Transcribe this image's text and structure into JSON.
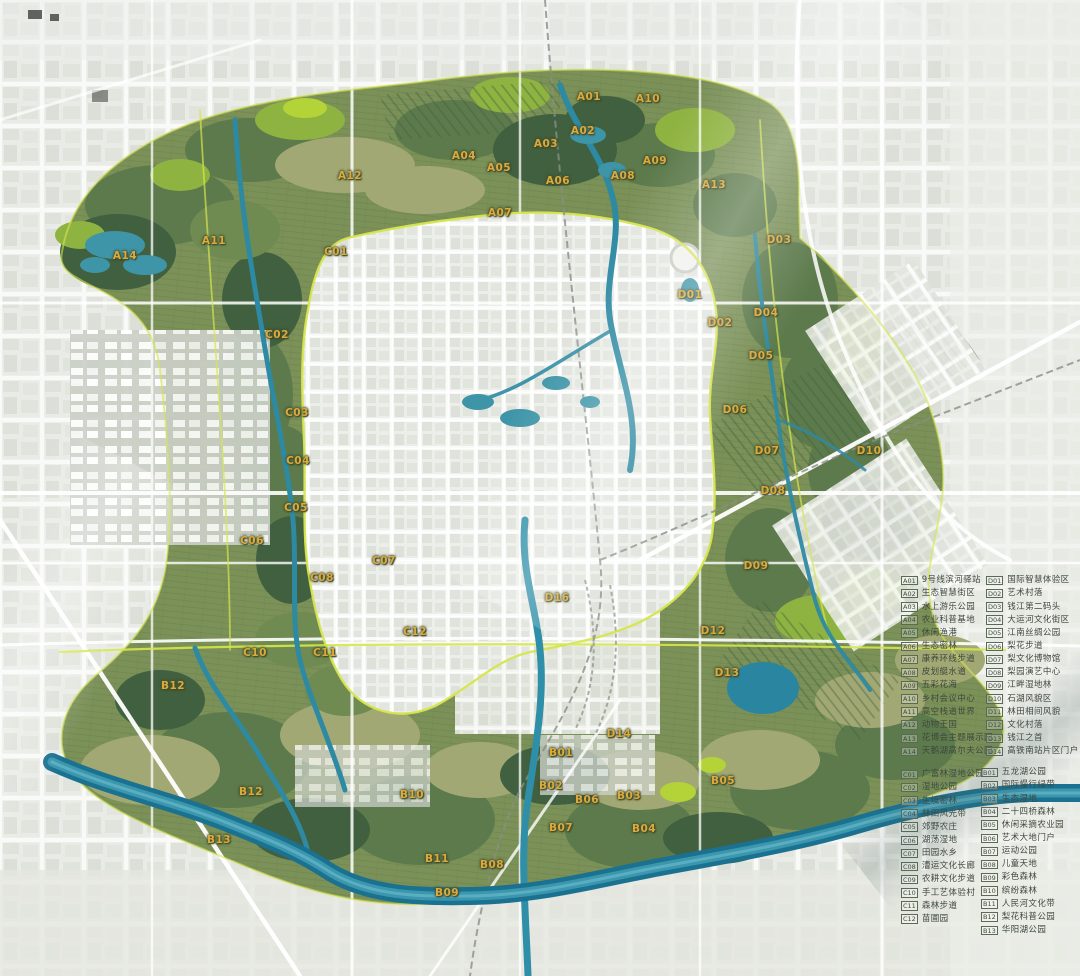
{
  "map": {
    "label_color": "#dcaa3c",
    "region_labels": [
      {
        "code": "A01",
        "x": 589,
        "y": 97
      },
      {
        "code": "A02",
        "x": 583,
        "y": 131
      },
      {
        "code": "A03",
        "x": 546,
        "y": 144
      },
      {
        "code": "A04",
        "x": 464,
        "y": 156
      },
      {
        "code": "A05",
        "x": 499,
        "y": 168
      },
      {
        "code": "A06",
        "x": 558,
        "y": 181
      },
      {
        "code": "A07",
        "x": 500,
        "y": 213
      },
      {
        "code": "A08",
        "x": 623,
        "y": 176
      },
      {
        "code": "A09",
        "x": 655,
        "y": 161
      },
      {
        "code": "A10",
        "x": 648,
        "y": 99
      },
      {
        "code": "A11",
        "x": 214,
        "y": 241
      },
      {
        "code": "A12",
        "x": 350,
        "y": 176
      },
      {
        "code": "A13",
        "x": 714,
        "y": 185
      },
      {
        "code": "A14",
        "x": 125,
        "y": 256
      },
      {
        "code": "C01",
        "x": 336,
        "y": 252
      },
      {
        "code": "C02",
        "x": 277,
        "y": 335
      },
      {
        "code": "C03",
        "x": 297,
        "y": 413
      },
      {
        "code": "C04",
        "x": 298,
        "y": 461
      },
      {
        "code": "C05",
        "x": 296,
        "y": 508
      },
      {
        "code": "C06",
        "x": 252,
        "y": 541
      },
      {
        "code": "C07",
        "x": 384,
        "y": 561
      },
      {
        "code": "C08",
        "x": 322,
        "y": 578
      },
      {
        "code": "C10",
        "x": 255,
        "y": 653
      },
      {
        "code": "C11",
        "x": 325,
        "y": 653
      },
      {
        "code": "C12",
        "x": 415,
        "y": 632
      },
      {
        "code": "D01",
        "x": 690,
        "y": 295
      },
      {
        "code": "D02",
        "x": 720,
        "y": 323
      },
      {
        "code": "D03",
        "x": 779,
        "y": 240
      },
      {
        "code": "D04",
        "x": 766,
        "y": 313
      },
      {
        "code": "D05",
        "x": 761,
        "y": 356
      },
      {
        "code": "D06",
        "x": 735,
        "y": 410
      },
      {
        "code": "D07",
        "x": 767,
        "y": 451
      },
      {
        "code": "D08",
        "x": 773,
        "y": 491
      },
      {
        "code": "D09",
        "x": 756,
        "y": 566
      },
      {
        "code": "D10",
        "x": 869,
        "y": 451
      },
      {
        "code": "D12",
        "x": 713,
        "y": 631
      },
      {
        "code": "D13",
        "x": 727,
        "y": 673
      },
      {
        "code": "D14",
        "x": 619,
        "y": 734
      },
      {
        "code": "D16",
        "x": 557,
        "y": 598
      },
      {
        "code": "B01",
        "x": 561,
        "y": 753
      },
      {
        "code": "B02",
        "x": 551,
        "y": 786
      },
      {
        "code": "B03",
        "x": 629,
        "y": 796
      },
      {
        "code": "B04",
        "x": 644,
        "y": 829
      },
      {
        "code": "B05",
        "x": 723,
        "y": 781
      },
      {
        "code": "B06",
        "x": 587,
        "y": 800
      },
      {
        "code": "B07",
        "x": 561,
        "y": 828
      },
      {
        "code": "B08",
        "x": 492,
        "y": 865
      },
      {
        "code": "B09",
        "x": 447,
        "y": 893
      },
      {
        "code": "B10",
        "x": 412,
        "y": 795
      },
      {
        "code": "B11",
        "x": 437,
        "y": 859
      },
      {
        "code": "B12",
        "x": 173,
        "y": 686
      },
      {
        "code": "B12",
        "x": 251,
        "y": 792
      },
      {
        "code": "B13",
        "x": 219,
        "y": 840
      }
    ]
  },
  "legend": {
    "groups": [
      {
        "id": "zone-a",
        "position": "top-left",
        "items": [
          {
            "code": "A01",
            "label": "9号线滨河驿站"
          },
          {
            "code": "A02",
            "label": "生态智慧街区"
          },
          {
            "code": "A03",
            "label": "水上游乐公园"
          },
          {
            "code": "A04",
            "label": "农业科普基地"
          },
          {
            "code": "A05",
            "label": "休闲渔港"
          },
          {
            "code": "A06",
            "label": "生态密林"
          },
          {
            "code": "A07",
            "label": "康养环线步道"
          },
          {
            "code": "A08",
            "label": "皮划艇水道"
          },
          {
            "code": "A09",
            "label": "五彩花海"
          },
          {
            "code": "A10",
            "label": "乡村会议中心"
          },
          {
            "code": "A11",
            "label": "高空栈道世界"
          },
          {
            "code": "A12",
            "label": "动物王国"
          },
          {
            "code": "A13",
            "label": "花博会主题展示园"
          },
          {
            "code": "A14",
            "label": "天鹅湖高尔夫公园"
          }
        ]
      },
      {
        "id": "zone-d",
        "position": "top-right",
        "items": [
          {
            "code": "D01",
            "label": "国际智慧体验区"
          },
          {
            "code": "D02",
            "label": "艺术村落"
          },
          {
            "code": "D03",
            "label": "钱江第二码头"
          },
          {
            "code": "D04",
            "label": "大运河文化街区"
          },
          {
            "code": "D05",
            "label": "江南丝绸公园"
          },
          {
            "code": "D06",
            "label": "梨花步道"
          },
          {
            "code": "D07",
            "label": "梨文化博物馆"
          },
          {
            "code": "D08",
            "label": "梨园演艺中心"
          },
          {
            "code": "D09",
            "label": "江畔湿地林"
          },
          {
            "code": "D10",
            "label": "石湖风貌区"
          },
          {
            "code": "D11",
            "label": "林田相间风貌"
          },
          {
            "code": "D12",
            "label": "文化村落"
          },
          {
            "code": "D13",
            "label": "钱江之首"
          },
          {
            "code": "D14",
            "label": "高铁南站片区门户"
          }
        ]
      },
      {
        "id": "zone-c",
        "position": "bottom-left",
        "items": [
          {
            "code": "C01",
            "label": "广富林湿地公园"
          },
          {
            "code": "C02",
            "label": "湿地公园"
          },
          {
            "code": "C03",
            "label": "生境密林"
          },
          {
            "code": "C04",
            "label": "林田风光带"
          },
          {
            "code": "C05",
            "label": "郊野农庄"
          },
          {
            "code": "C06",
            "label": "湖荡湿地"
          },
          {
            "code": "C07",
            "label": "田园水乡"
          },
          {
            "code": "C08",
            "label": "漕运文化长廊"
          },
          {
            "code": "C09",
            "label": "农耕文化步道"
          },
          {
            "code": "C10",
            "label": "手工艺体验村"
          },
          {
            "code": "C11",
            "label": "森林步道"
          },
          {
            "code": "C12",
            "label": "苗圃园"
          }
        ]
      },
      {
        "id": "zone-b",
        "position": "bottom-right",
        "items": [
          {
            "code": "B01",
            "label": "五龙湖公园"
          },
          {
            "code": "B02",
            "label": "国际慢行绿带"
          },
          {
            "code": "B03",
            "label": "生态湿地"
          },
          {
            "code": "B04",
            "label": "二十四桥森林"
          },
          {
            "code": "B05",
            "label": "休闲采摘农业园"
          },
          {
            "code": "B06",
            "label": "艺术大地门户"
          },
          {
            "code": "B07",
            "label": "运动公园"
          },
          {
            "code": "B08",
            "label": "儿童天地"
          },
          {
            "code": "B09",
            "label": "彩色森林"
          },
          {
            "code": "B10",
            "label": "缤纷森林"
          },
          {
            "code": "B11",
            "label": "人民河文化带"
          },
          {
            "code": "B12",
            "label": "梨花科普公园"
          },
          {
            "code": "B13",
            "label": "华阳湖公园"
          }
        ]
      }
    ]
  },
  "colors": {
    "greenbelt": "#7b9158",
    "forest_dark": "#40603f",
    "green_bright": "#8fb341",
    "water": "#2e8aa3",
    "river_main": "#1b7190",
    "road_accent": "#d6e54e",
    "urban": "#e7e9e4",
    "label_gold": "#dcaa3c"
  }
}
